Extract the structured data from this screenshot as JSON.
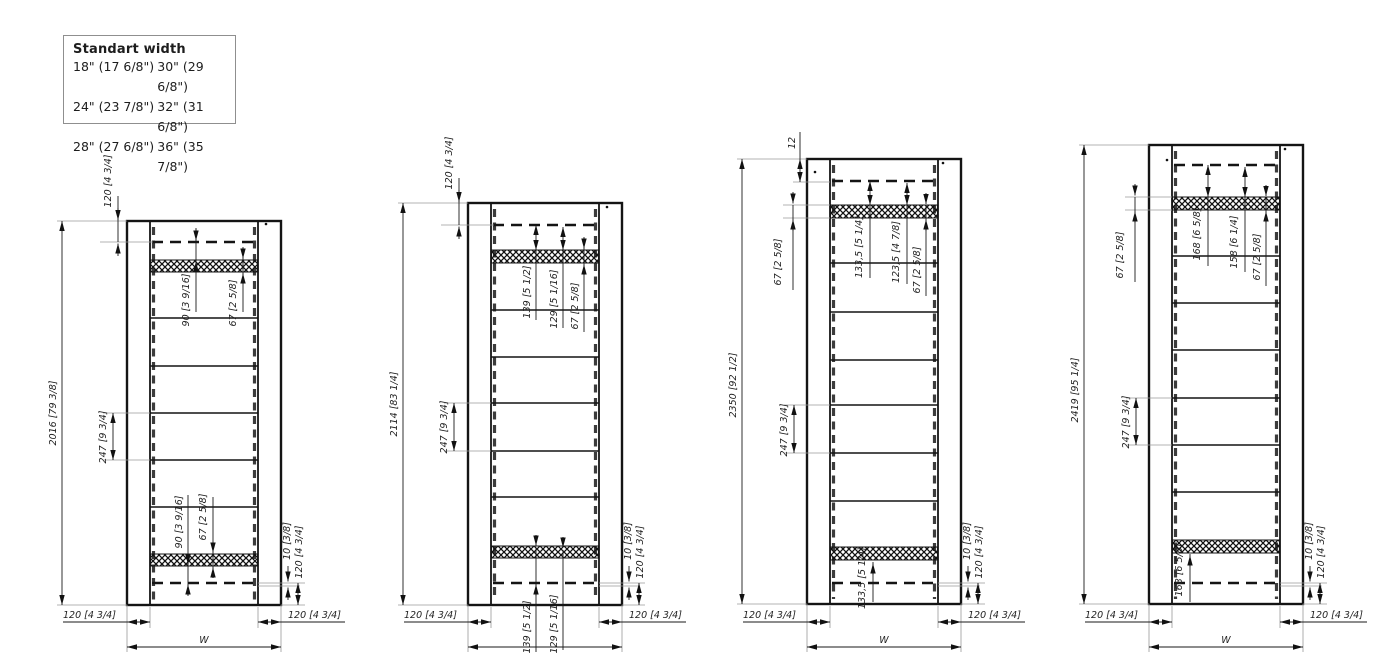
{
  "legend": {
    "title": "Standart width",
    "rows": [
      {
        "c1": "18\" (17 6/8\")",
        "c2": "30\" (29 6/8\")"
      },
      {
        "c1": "24\" (23 7/8\")",
        "c2": "32\" (31 6/8\")"
      },
      {
        "c1": "28\" (27 6/8\")",
        "c2": "36\" (35 7/8\")"
      }
    ]
  },
  "drawings": [
    {
      "overall": "2016 [79 3/8]",
      "top_offset": "120 [4 3/4]",
      "top_inner": [
        "90 [3 9/16]",
        "67 [2 5/8]"
      ],
      "spacing": "247 [9 3/4]",
      "bottom_inner": [
        "90 [3 9/16]",
        "67 [2 5/8]"
      ],
      "bottom_gap": "10 [3/8]",
      "bottom_offset": "120 [4 3/4]",
      "left_stile": "120 [4 3/4]",
      "right_stile": "120 [4 3/4]",
      "width": "W"
    },
    {
      "overall": "2114 [83 1/4]",
      "top_offset": "120 [4 3/4]",
      "top_inner": [
        "139 [5 1/2]",
        "129 [5 1/16]",
        "67 [2 5/8]"
      ],
      "spacing": "247 [9 3/4]",
      "bottom_inner": [
        "139 [5 1/2]",
        "129 [5 1/16]"
      ],
      "bottom_gap": "10 [3/8]",
      "bottom_offset": "120 [4 3/4]",
      "left_stile": "120 [4 3/4]",
      "right_stile": "120 [4 3/4]"
    },
    {
      "overall": "2350 [92 1/2]",
      "top_offset": "12",
      "left_band": "67 [2 5/8]",
      "top_inner": [
        "133,5 [5 1/4]",
        "123,5 [4 7/8]",
        "67 [2 5/8]"
      ],
      "spacing": "247 [9 3/4]",
      "bottom_inner": [
        "133,5 [5 1/4]"
      ],
      "bottom_gap": "10 [3/8]",
      "bottom_offset": "120 [4 3/4]",
      "left_stile": "120 [4 3/4]",
      "right_stile": "120 [4 3/4]",
      "width": "W"
    },
    {
      "overall": "2419 [95 1/4]",
      "left_band": "67 [2 5/8]",
      "top_inner": [
        "168 [6 5/8]",
        "158 [6 1/4]",
        "67 [2 5/8]"
      ],
      "spacing": "247 [9 3/4]",
      "bottom_inner": [
        "168 [6 5/8]"
      ],
      "bottom_gap": "10 [3/8]",
      "bottom_offset": "120 [4 3/4]",
      "left_stile": "120 [4 3/4]",
      "right_stile": "120 [4 3/4]",
      "width": "W"
    }
  ]
}
